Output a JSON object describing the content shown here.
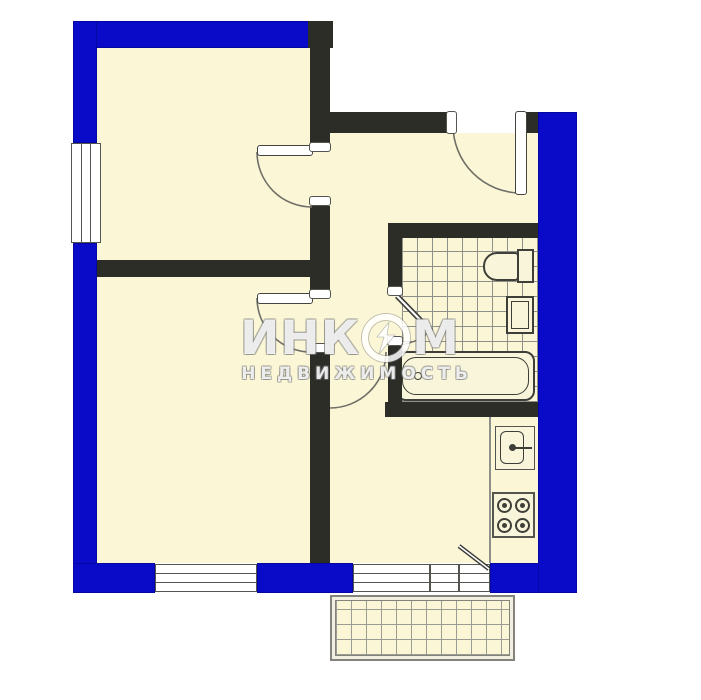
{
  "watermark": {
    "line1_prefix": "ИНК",
    "line1_suffix": "М",
    "line2": "НЕДВИЖИМОСТЬ"
  },
  "palette": {
    "exterior_wall_blue": "#0a0ac9",
    "interior_wall_dark": "#2d2d28",
    "floor_cream": "#fbf7d6",
    "tile_line_gray": "#8f9089",
    "frame_outline": "#55554f",
    "fixture_outline": "#3f3f39",
    "balcony_outline": "#83837b",
    "watermark_fill": "rgba(255,255,255,0.85)"
  },
  "plan": {
    "areas": [
      "room-upper-left",
      "room-lower-left",
      "entrance-hall",
      "bathroom",
      "kitchen",
      "balcony"
    ],
    "fixtures": [
      "toilet",
      "washbasin",
      "bathtub",
      "kitchen-sink",
      "stove-4-burner"
    ],
    "openings": [
      "entrance-door",
      "upper-room-door",
      "lower-room-door",
      "bathroom-door",
      "kitchen-door",
      "balcony-door",
      "window-left",
      "window-bottom",
      "window-kitchen"
    ]
  }
}
